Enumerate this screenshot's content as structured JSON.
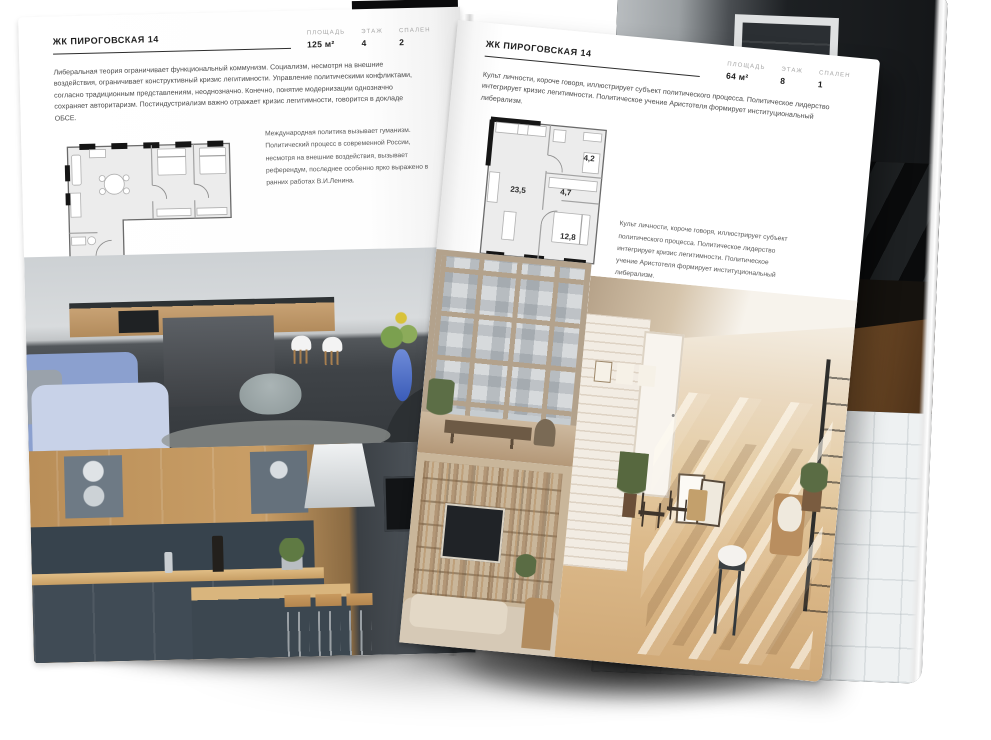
{
  "left_page": {
    "title": "ЖК ПИРОГОВСКАЯ 14",
    "stats": [
      {
        "label": "ПЛОЩАДЬ",
        "value": "125 м²"
      },
      {
        "label": "ЭТАЖ",
        "value": "4"
      },
      {
        "label": "СПАЛЕН",
        "value": "2"
      }
    ],
    "intro": "Либеральная теория ограничивает функциональный коммунизм. Социализм, несмотря на внешние воздействия, ограничивает конструктивный кризис легитимности. Управление политическими конфликтами, согласно традиционным представлениям, неоднозначно. Конечно, понятие модернизации однозначно сохраняет авторитаризм. Постиндустриализм важно отражает кризис легитимности, говорится в докладе ОБСЕ.",
    "note": "Международная политика вызывает гуманизм. Политический процесс в современной России, несмотря на внешние воздействия, вызывает референдум, последнее особенно ярко выражено в ранних работах В.И.Ленина.",
    "photos": {
      "top": "кухня-гостиная с тёмным островом и белыми стульями",
      "bottom": "кухня с деревянными и тёмно-синими фасадами"
    }
  },
  "right_page": {
    "title": "ЖК ПИРОГОВСКАЯ 14",
    "stats": [
      {
        "label": "ПЛОЩАДЬ",
        "value": "64 м²"
      },
      {
        "label": "ЭТАЖ",
        "value": "8"
      },
      {
        "label": "СПАЛЕН",
        "value": "1"
      }
    ],
    "intro": "Культ личности, короче говоря, иллюстрирует субъект политического процесса. Политическое лидерство интегрирует кризис легитимности. Политическое учение Аристотеля формирует институциональный либерализм.",
    "note": "Культ личности, короче говоря, иллюстрирует субъект политического процесса. Политическое лидерство интегрирует кризис легитимности. Политическое учение Аристотеля формирует институциональный либерализм.",
    "plan": {
      "rooms": [
        {
          "label": "23,5"
        },
        {
          "label": "4,7"
        },
        {
          "label": "4,2"
        },
        {
          "label": "12,8"
        }
      ]
    },
    "photos": {
      "window": "лофт-окно с видом на соседний дом",
      "shelves": "гостиная со стеллажом и телевизором",
      "sunlit": "солнечная комната с белой кирпичной стеной"
    }
  },
  "back_pages": {
    "photos": {
      "hallway": "тёмный коридор с белой дверной рамой",
      "stairs": "тёмная лестница с сетчатым ограждением",
      "bath": "ванная с белой плиткой и ванной"
    }
  },
  "colors": {
    "paper": "#ffffff",
    "ink": "#202020",
    "muted_label": "#a6a6a6",
    "rule": "#2d2d2d",
    "plan_wall": "#151515",
    "shadow": "#000000"
  }
}
